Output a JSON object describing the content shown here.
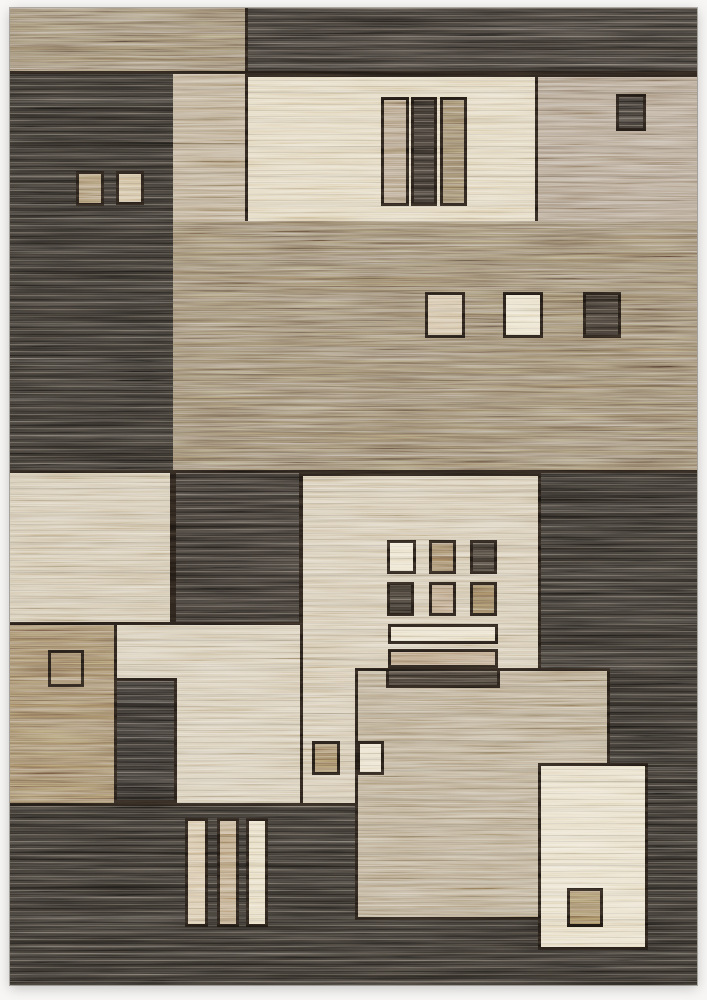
{
  "image": {
    "kind": "product-photo",
    "subject": "modern geometric block-pattern area rug in charcoal, brown, tan, beige and cream",
    "background": "#f7f6f4"
  },
  "palette": {
    "outline": "#1d1712",
    "charcoal": "#2e2a25",
    "brown": "#8c7961",
    "tan": "#b1a083",
    "beige": "#ccbea3",
    "cream": "#e4d9bf"
  },
  "elements": {
    "rug_base": "#2e2a25",
    "top_band_brown": "#8d7a62",
    "top_band_dark": "#35302b",
    "tan_strip": "#b3a184",
    "brown_band": "#8c7961",
    "cream_top_panel": "#ddd0b3",
    "bar_top_tan": "#a99478",
    "bar_top_dark": "#332d27",
    "bar_top_brown": "#8f7a5e",
    "tan_top_right": "#a7957f",
    "sq_top_right_dark": "#332e29",
    "sq_band_beige": "#ccb999",
    "sq_band_cream": "#e7ddc3",
    "sq_band_dark": "#39322b",
    "sq_col_brown": "#a28a67",
    "sq_col_beige": "#c8b48f",
    "left_beige_panel": "#ccbea3",
    "dark_mid_block": "#322d28",
    "brown_bottom_left": "#93795a",
    "panel_c": "#d0c3a9",
    "panel_a": "#cec0a5",
    "grid_1_cream": "#e8ddc3",
    "grid_2_brown": "#94795a",
    "grid_3_dark": "#3d362e",
    "grid_4_dark": "#363029",
    "grid_5_tan": "#b29878",
    "grid_6_brown": "#8a7050",
    "bar_mid_cream": "#e5dac0",
    "bar_mid_tan": "#b09676",
    "bar_mid_dark": "#3b342c",
    "panel_b": "#b1a083",
    "sq_a_brown": "#9c8260",
    "sq_b_cream": "#e7dcc4",
    "bbar_beige": "#d1be9d",
    "bbar_tan": "#b59c78",
    "bbar_cream": "#e2d6b8",
    "dark_vert_block": "#2d2925",
    "cream_bottom_panel": "#e4d9bf",
    "sq_bottom_brown": "#977d58"
  }
}
